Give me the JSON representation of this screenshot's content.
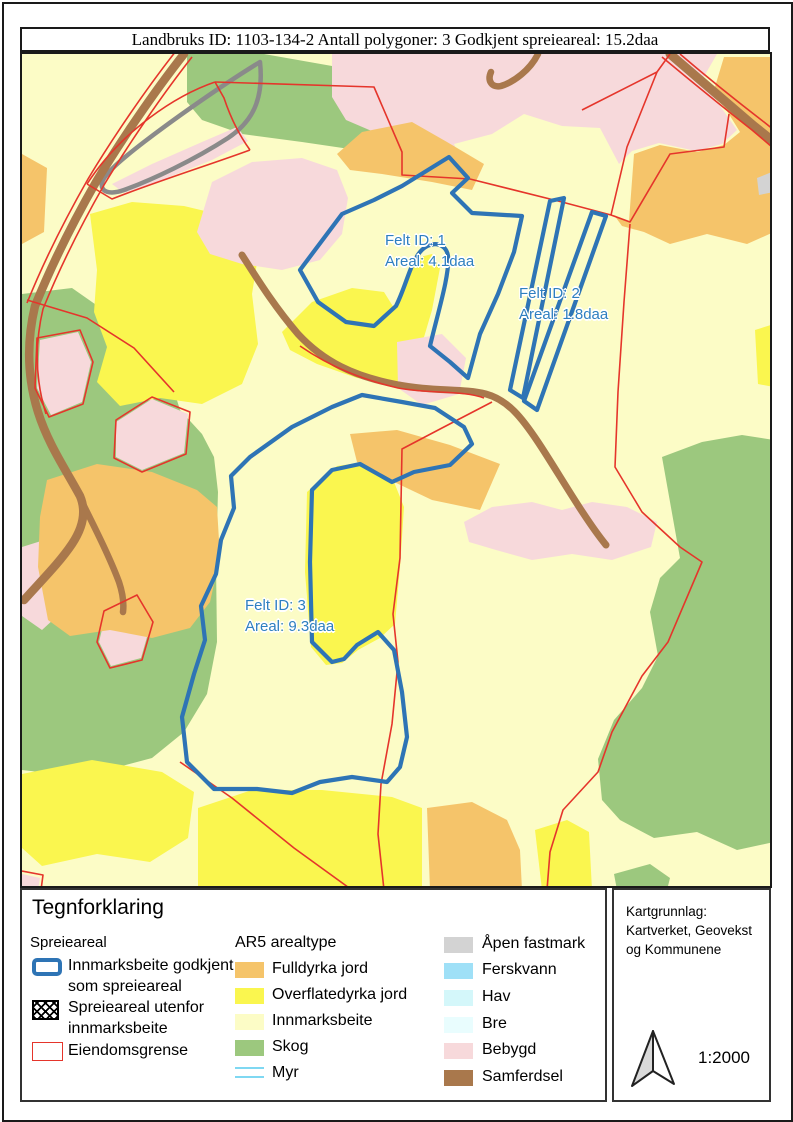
{
  "title": "Landbruks ID: 1103-134-2 Antall polygoner: 3 Godkjent spreieareal: 15.2daa",
  "map": {
    "felt_labels": [
      {
        "line1": "Felt ID: 1",
        "line2": "Areal: 4.1daa"
      },
      {
        "line1": "Felt ID: 2",
        "line2": "Areal: 1.8daa"
      },
      {
        "line1": "Felt ID: 3",
        "line2": "Areal: 9.3daa"
      }
    ]
  },
  "legend": {
    "title": "Tegnforklaring",
    "spreieareal": {
      "heading": "Spreieareal",
      "items": [
        {
          "label_line1": "Innmarksbeite godkjent",
          "label_line2": "som spreieareal",
          "swatch": "blue-outline-rounded"
        },
        {
          "label_line1": "Spreieareal utenfor",
          "label_line2": "innmarksbeite",
          "swatch": "black-crosshatch"
        },
        {
          "label_line1": "Eiendomsgrense",
          "label_line2": "",
          "swatch": "red-outline"
        }
      ]
    },
    "ar5": {
      "heading": "AR5 arealtype",
      "items": [
        {
          "label": "Fulldyrka jord",
          "color": "#F5C46A"
        },
        {
          "label": "Overflatedyrka jord",
          "color": "#FAF64F"
        },
        {
          "label": "Innmarksbeite",
          "color": "#FCFCC6"
        },
        {
          "label": "Skog",
          "color": "#9CC87E"
        },
        {
          "label": "Myr",
          "color": "#7FD8F2",
          "swatch": "double-line"
        }
      ]
    },
    "right_column": {
      "items": [
        {
          "label": "Åpen fastmark",
          "color": "#D3D3D3"
        },
        {
          "label": "Ferskvann",
          "color": "#9FE0F7"
        },
        {
          "label": "Hav",
          "color": "#D4F7FA"
        },
        {
          "label": "Bre",
          "color": "#E9FDFE"
        },
        {
          "label": "Bebygd",
          "color": "#F7D9DB"
        },
        {
          "label": "Samferdsel",
          "color": "#A9784C"
        }
      ]
    }
  },
  "info_box": {
    "attribution_line1": "Kartgrunnlag:",
    "attribution_line2": "Kartverket, Geovekst",
    "attribution_line3": "og Kommunene",
    "scale": "1:2000"
  },
  "colors": {
    "spreieareal_outline": "#2E74B5",
    "eiendomsgrense": "#E5352B",
    "felt_label_text": "#2E7FC0",
    "road": "#A9784C",
    "gray_track": "#8A8A8A",
    "map_background_innmarksbeite": "#FCFCC6"
  }
}
